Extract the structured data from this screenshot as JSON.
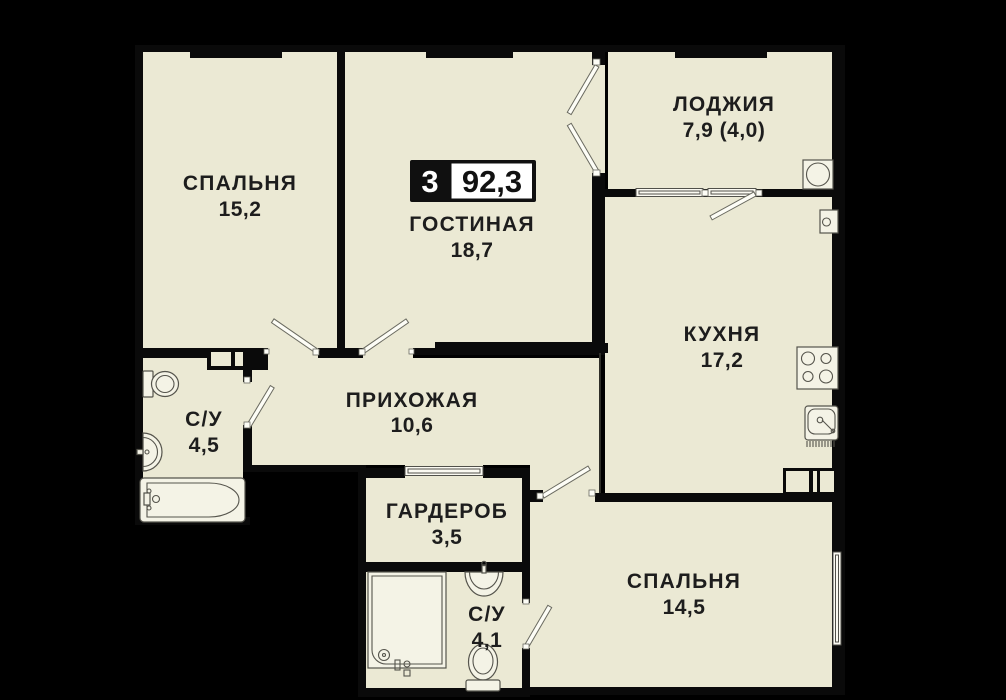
{
  "apartment_plan": {
    "badge": {
      "rooms_count": "3",
      "total_area": "92,3"
    },
    "rooms": [
      {
        "key": "bedroom-1",
        "label": "СПАЛЬНЯ",
        "area": "15,2"
      },
      {
        "key": "living-room",
        "label": "ГОСТИНАЯ",
        "area": "18,7"
      },
      {
        "key": "loggia",
        "label": "ЛОДЖИЯ",
        "area": "7,9 (4,0)"
      },
      {
        "key": "kitchen",
        "label": "КУХНЯ",
        "area": "17,2"
      },
      {
        "key": "hallway",
        "label": "ПРИХОЖАЯ",
        "area": "10,6"
      },
      {
        "key": "bathroom-1",
        "label": "С/У",
        "area": "4,5"
      },
      {
        "key": "wardrobe",
        "label": "ГАРДЕРОБ",
        "area": "3,5"
      },
      {
        "key": "bathroom-2",
        "label": "С/У",
        "area": "4,1"
      },
      {
        "key": "bedroom-2",
        "label": "СПАЛЬНЯ",
        "area": "14,5"
      }
    ],
    "colors": {
      "background": "#000000",
      "floor": "#ebe9d4",
      "wall": "#0a0a0a",
      "badge_background": "#101010",
      "badge_panel": "#ffffff",
      "label_text": "#1d1d1d",
      "fixture_outline": "#55544c"
    }
  }
}
